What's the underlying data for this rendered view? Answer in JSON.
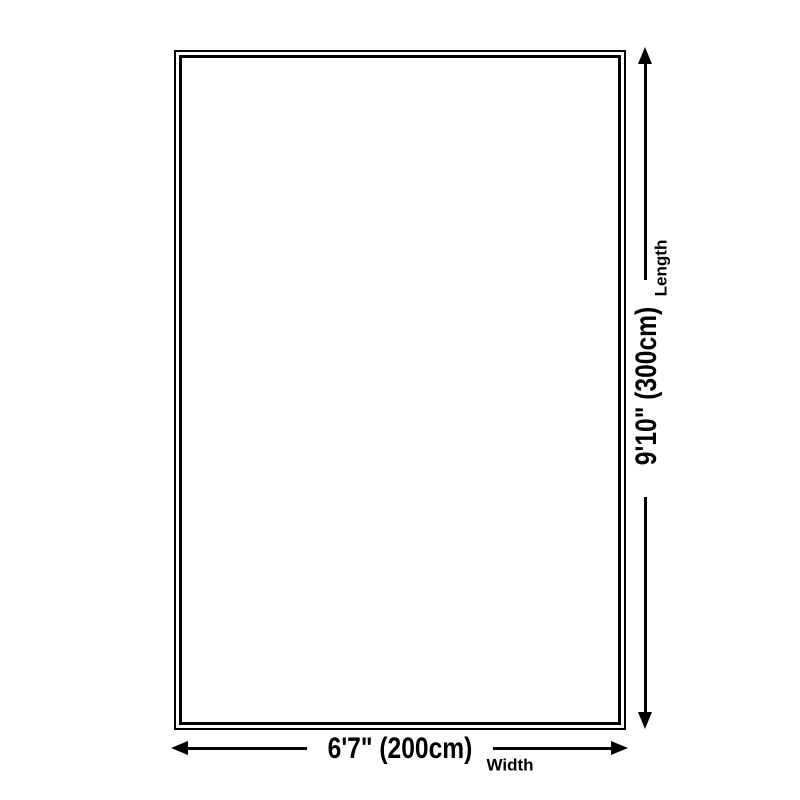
{
  "diagram": {
    "type": "product-dimension-diagram",
    "shape": "rectangle",
    "colors": {
      "line": "#000000",
      "background": "#ffffff",
      "rug_fill": "#ffffff"
    },
    "width": {
      "value": "6'7\" (200cm)",
      "label": "Width"
    },
    "length": {
      "value": "9'10\" (300cm)",
      "label": "Length"
    }
  }
}
